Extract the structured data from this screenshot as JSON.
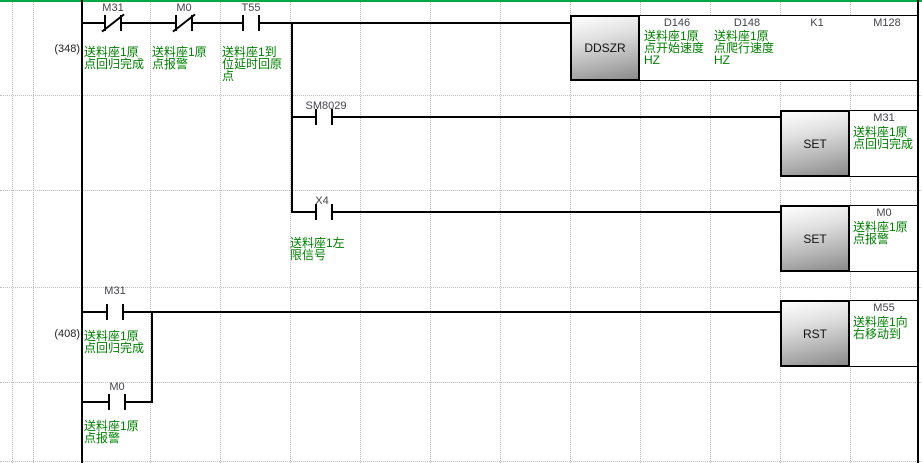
{
  "editor": {
    "background": "#ffffff",
    "top_border_color": "#00a843",
    "comment_color": "#008000",
    "device_color": "#45454d",
    "line_color": "#000000"
  },
  "rung_348": {
    "step": "(348)",
    "contact_m31": {
      "device": "M31",
      "type": "normally-closed",
      "comment": [
        "送料座1原",
        "点回归完成"
      ]
    },
    "contact_m0": {
      "device": "M0",
      "type": "normally-closed",
      "comment": [
        "送料座1原",
        "点报警"
      ]
    },
    "contact_t55": {
      "device": "T55",
      "type": "normally-open",
      "comment": [
        "送料座1到",
        "位延时回原",
        "点"
      ]
    },
    "instruction": {
      "mnemonic": "DDSZR",
      "operand1": {
        "device": "D146",
        "comment": [
          "送料座1原",
          "点开始速度",
          "HZ"
        ]
      },
      "operand2": {
        "device": "D148",
        "comment": [
          "送料座1原",
          "点爬行速度",
          "HZ"
        ]
      },
      "operand3": {
        "device": "K1"
      },
      "operand4": {
        "device": "M128"
      }
    },
    "branch_sm8029": {
      "contact": {
        "device": "SM8029",
        "type": "normally-open"
      },
      "instruction": {
        "mnemonic": "SET",
        "operand": {
          "device": "M31",
          "comment": [
            "送料座1原",
            "点回归完成"
          ]
        }
      }
    },
    "branch_x4": {
      "contact": {
        "device": "X4",
        "type": "normally-open",
        "comment": [
          "送料座1左",
          "限信号"
        ]
      },
      "instruction": {
        "mnemonic": "SET",
        "operand": {
          "device": "M0",
          "comment": [
            "送料座1原",
            "点报警"
          ]
        }
      }
    }
  },
  "rung_408": {
    "step": "(408)",
    "contact_m31": {
      "device": "M31",
      "type": "normally-open",
      "comment": [
        "送料座1原",
        "点回归完成"
      ]
    },
    "contact_m0_parallel": {
      "device": "M0",
      "type": "normally-open",
      "comment": [
        "送料座1原",
        "点报警"
      ]
    },
    "instruction": {
      "mnemonic": "RST",
      "operand": {
        "device": "M55",
        "comment": [
          "送料座1向",
          "右移动到"
        ]
      }
    }
  }
}
